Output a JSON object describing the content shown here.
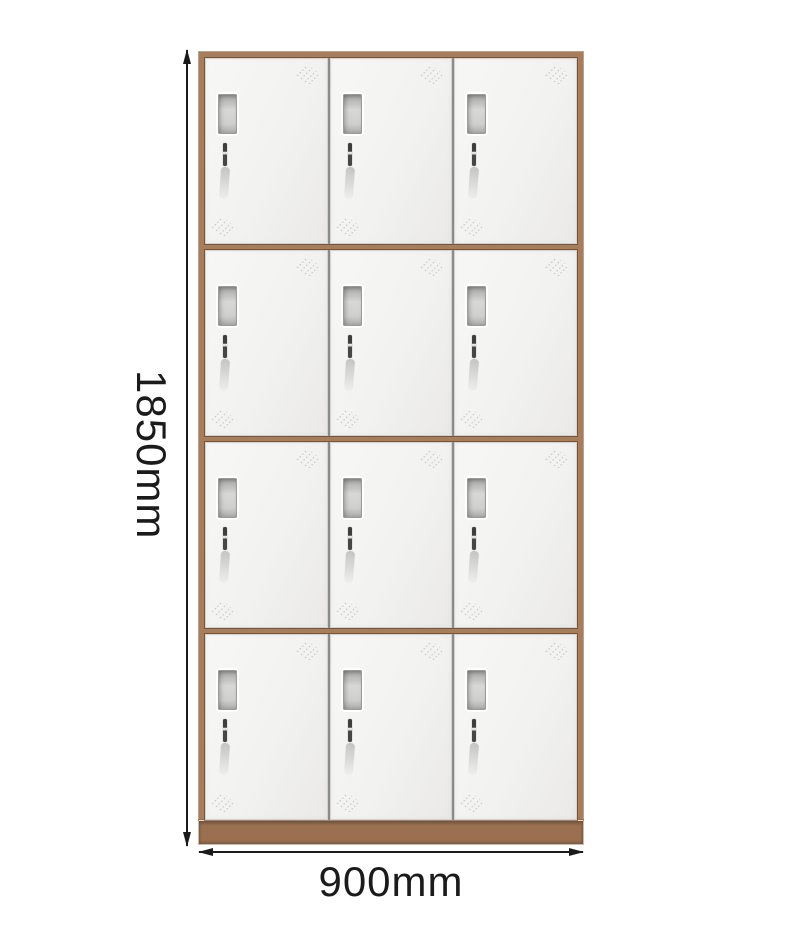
{
  "product_diagram": {
    "item": "12-door locker cabinet with dimension annotations",
    "grid": {
      "rows": 4,
      "columns": 3
    },
    "dimensions": {
      "height_label": "1850mm",
      "width_label": "900mm"
    }
  },
  "colors": {
    "frame": "#a87d5c",
    "base": "#9a7051",
    "door_face": "#f3f3f2",
    "door_gap": "#8b8b8b",
    "hatch": "#c8c8c8",
    "dimension": "#1b1b1b",
    "background": "#ffffff"
  }
}
